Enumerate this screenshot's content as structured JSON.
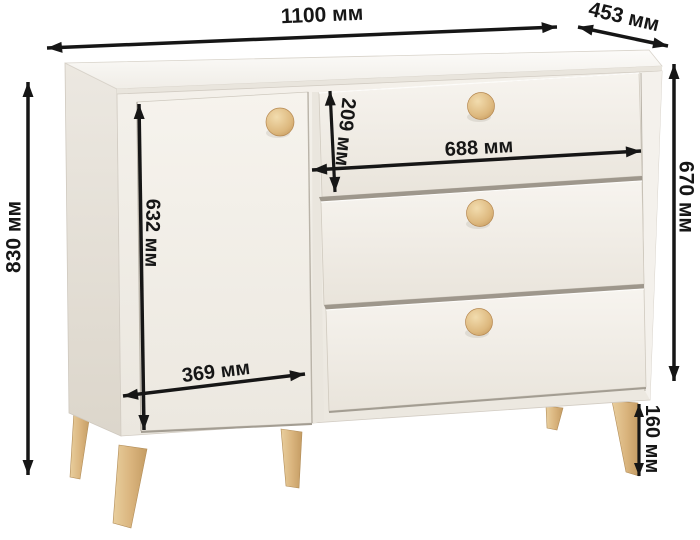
{
  "diagram": {
    "kind": "furniture-dimension-diagram",
    "subject": "chest-of-drawers-with-door-and-three-drawers",
    "unit": "мм"
  },
  "dimensions": {
    "overall_width": {
      "value": 1100,
      "label": "1100 мм"
    },
    "depth": {
      "value": 453,
      "label": "453 мм"
    },
    "overall_height": {
      "value": 830,
      "label": "830 мм"
    },
    "body_height": {
      "value": 670,
      "label": "670 мм"
    },
    "leg_height": {
      "value": 160,
      "label": "160 мм"
    },
    "door_height": {
      "value": 632,
      "label": "632 мм"
    },
    "door_width": {
      "value": 369,
      "label": "369 мм"
    },
    "drawer_height": {
      "value": 209,
      "label": "209 мм"
    },
    "drawer_width": {
      "value": 688,
      "label": "688 мм"
    }
  },
  "colors": {
    "background": "#ffffff",
    "dimension_ink": "#161616",
    "body_front": "#f2efe9",
    "body_side": "#e6e1d9",
    "body_top": "#f8f6f2",
    "seam": "#9e978c",
    "wood_knob": "#dfbc85",
    "wood_leg": "#d9b37c"
  }
}
